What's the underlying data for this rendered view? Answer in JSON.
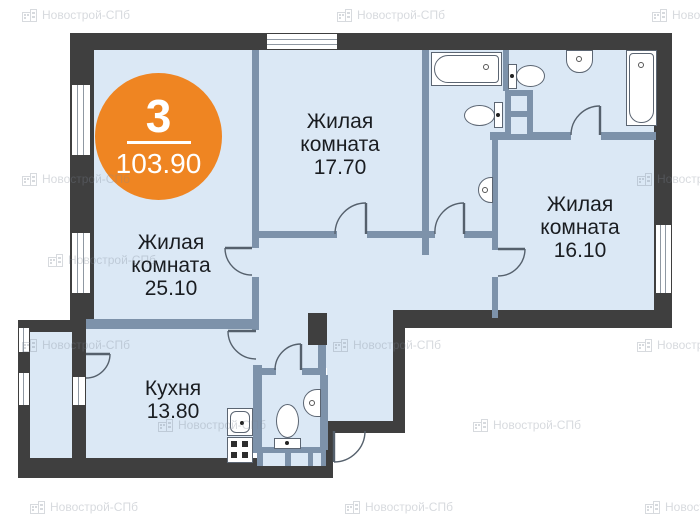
{
  "badge": {
    "flat_number": "3",
    "total_area": "103.90"
  },
  "rooms": {
    "living_a": {
      "lines": [
        "Жилая",
        "комната",
        "17.70"
      ]
    },
    "living_b": {
      "lines": [
        "Жилая",
        "комната",
        "25.10"
      ]
    },
    "living_c": {
      "lines": [
        "Жилая",
        "комната",
        "16.10"
      ]
    },
    "kitchen": {
      "lines": [
        "Кухня",
        "13.80"
      ]
    }
  },
  "watermark": {
    "text": "Новострой-СПб"
  },
  "colors": {
    "outer_wall": "#3f3f3f",
    "partition_wall": "#7d92aa",
    "floor": "#dbe8f5",
    "accent_orange": "#ef8522",
    "label_text": "#1a1d21"
  }
}
